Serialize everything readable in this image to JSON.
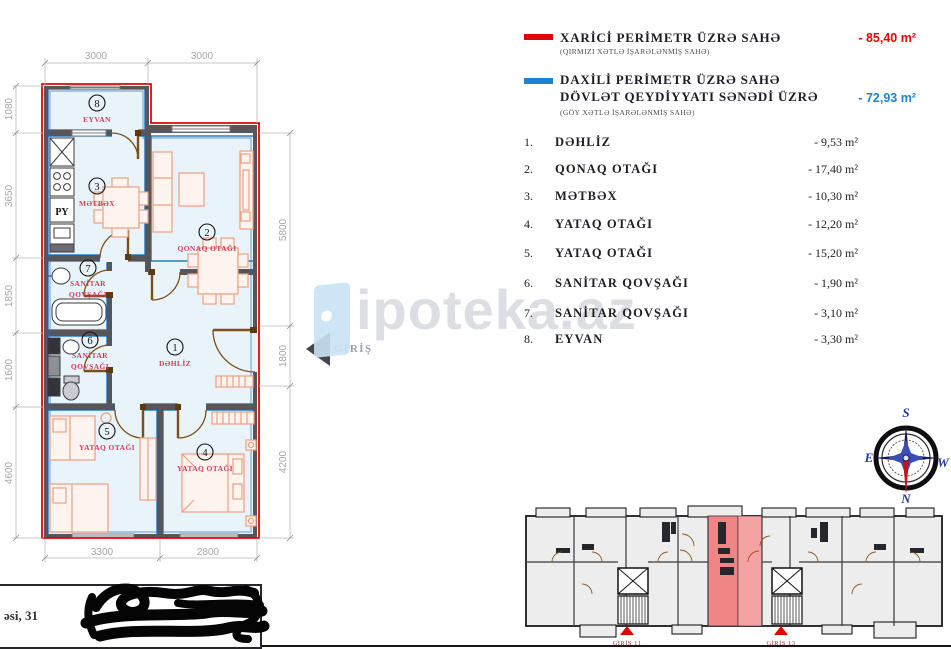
{
  "colors": {
    "outer_perimeter_red": "#e10600",
    "inner_perimeter_blue": "#1e82d2",
    "room_fill": "#e9f3fa",
    "wall": "#54565c",
    "furniture": "#ef9f7f",
    "door_arc": "#7c4f14",
    "room_label_red": "#d23c5a",
    "keyplan_highlight": "#ef8585"
  },
  "legend": {
    "outer": {
      "title": "XARİCİ PERİMETR ÜZRƏ SAHƏ",
      "subtitle": "(QIRMIZI XƏTLƏ İŞARƏLƏNMİŞ SAHƏ)",
      "value": "- 85,40 m²"
    },
    "inner": {
      "title_line1": "DAXİLİ PERİMETR ÜZRƏ SAHƏ",
      "title_line2": "DÖVLƏT QEYDİYYATI SƏNƏDİ ÜZRƏ",
      "subtitle": "(GÖY XƏTLƏ İŞARƏLƏNMİŞ SAHƏ)",
      "value": "- 72,93 m²"
    }
  },
  "rooms": [
    {
      "num": "1.",
      "name": "DƏHLİZ",
      "area": "- 9,53 m²"
    },
    {
      "num": "2.",
      "name": "QONAQ  OTAĞI",
      "area": "- 17,40 m²"
    },
    {
      "num": "3.",
      "name": "MƏTBƏX",
      "area": "- 10,30 m²"
    },
    {
      "num": "4.",
      "name": "YATAQ OTAĞI",
      "area": "- 12,20 m²"
    },
    {
      "num": "5.",
      "name": "YATAQ OTAĞI",
      "area": "- 15,20 m²"
    },
    {
      "num": "6.",
      "name": "SANİTAR QOVŞAĞI",
      "area": "- 1,90 m²"
    },
    {
      "num": "7.",
      "name": "SANİTAR QOVŞAĞI",
      "area": "- 3,10 m²"
    },
    {
      "num": "8.",
      "name": "EYVAN",
      "area": "- 3,30 m²"
    }
  ],
  "plan": {
    "dims": {
      "top": [
        "3000",
        "3000"
      ],
      "left": [
        "1080",
        "3650",
        "1850",
        "1600",
        "4600"
      ],
      "right": [
        "5800",
        "1800",
        "4200"
      ],
      "bottom": [
        "3300",
        "2800"
      ]
    },
    "labels": {
      "r1": {
        "num": "1",
        "name": "DƏHLİZ"
      },
      "r2": {
        "num": "2",
        "name": "QONAQ OTAĞI"
      },
      "r3": {
        "num": "3",
        "name": "MƏTBƏX"
      },
      "r4": {
        "num": "4",
        "name": "YATAQ OTAĞI"
      },
      "r5": {
        "num": "5",
        "name": "YATAQ OTAĞI"
      },
      "r6": {
        "num": "6",
        "name1": "SANİTAR",
        "name2": "QOVŞAĞI"
      },
      "r7": {
        "num": "7",
        "name1": "SANİTAR",
        "name2": "QOVŞAĞI"
      },
      "r8": {
        "num": "8",
        "name": "EYVAN"
      }
    },
    "kitchen_unit_label": "PY",
    "entrance_label": "GİRİŞ"
  },
  "watermark": {
    "text": "ipoteka.az"
  },
  "compass": {
    "n": "N",
    "s": "S",
    "e": "E",
    "w": "W"
  },
  "keyplan": {
    "entrance1": "GİRİŞ 11",
    "entrance2": "GİRİŞ 13"
  },
  "address": {
    "visible_text": "əsi, 31"
  }
}
